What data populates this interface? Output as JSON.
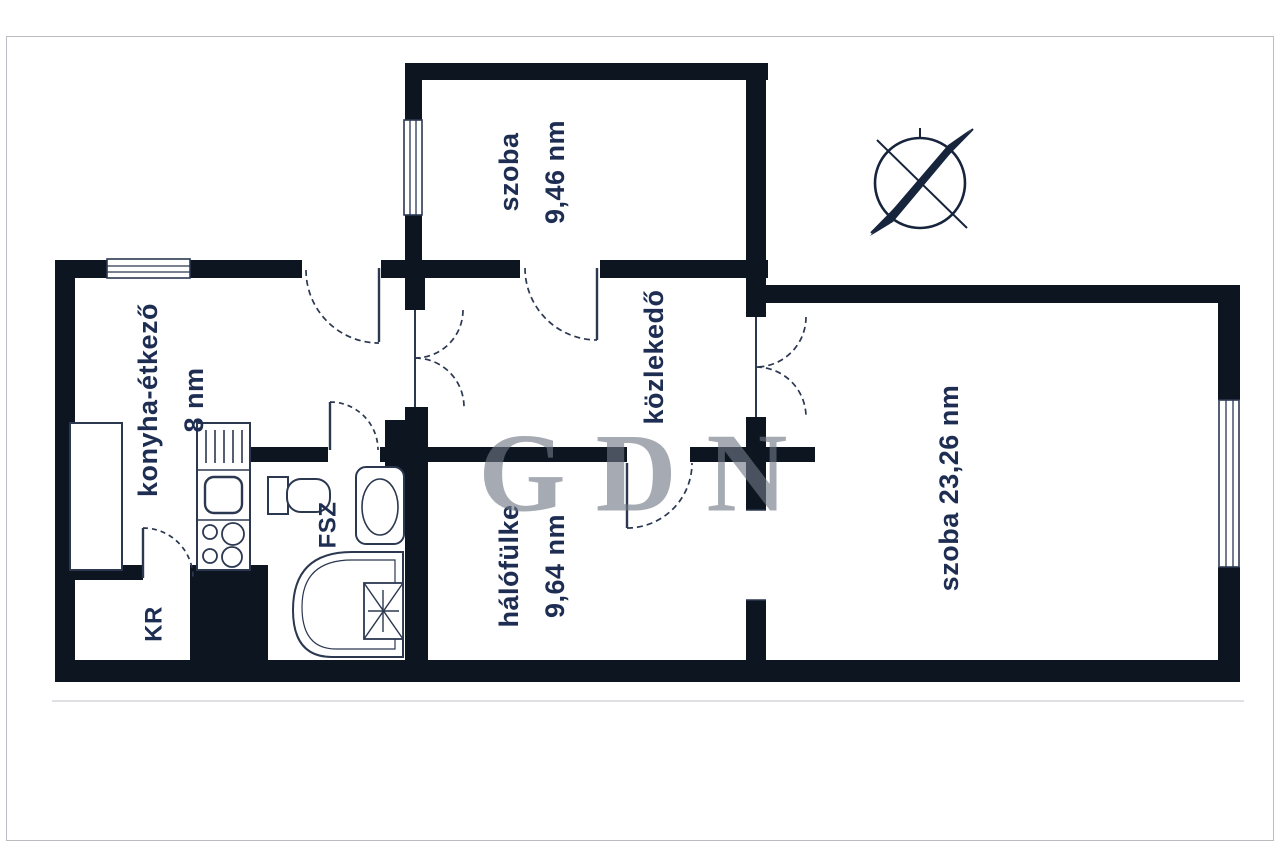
{
  "plan": {
    "rooms": [
      {
        "key": "room-small",
        "name": "szoba",
        "area": "9,46 nm"
      },
      {
        "key": "kitchen",
        "name": "konyha-étkező",
        "area": "8 nm"
      },
      {
        "key": "hall",
        "name": "közlekedő",
        "area": ""
      },
      {
        "key": "sleeping-nook",
        "name": "hálófülke",
        "area": "9,64 nm"
      },
      {
        "key": "room-large",
        "name": "szoba",
        "area": "23,26 nm"
      },
      {
        "key": "pantry",
        "name": "KR",
        "area": ""
      },
      {
        "key": "bathroom",
        "name": "FSZ",
        "area": ""
      }
    ],
    "watermark": "GDN",
    "colors": {
      "wall": "#0d1520",
      "line": "#2b3850",
      "text": "#1e2d52",
      "watermark": "#707885"
    }
  }
}
